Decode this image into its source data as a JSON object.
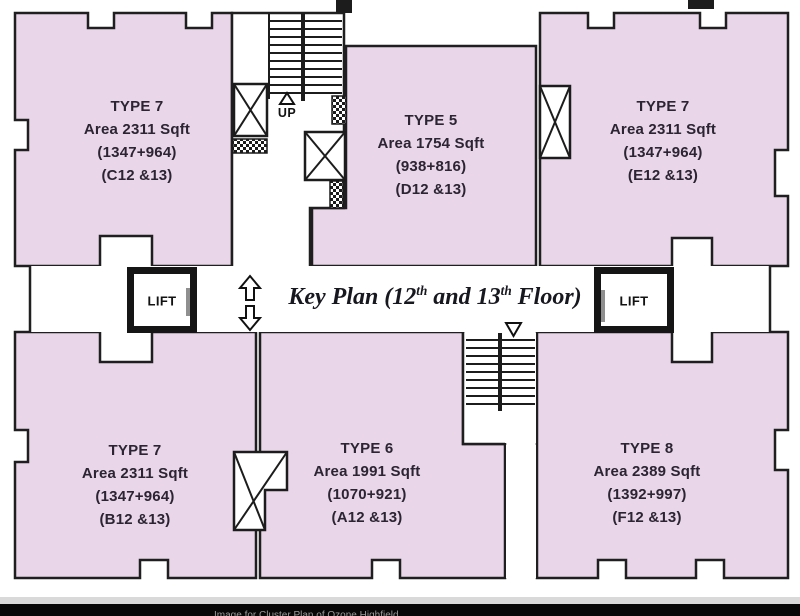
{
  "plan": {
    "title": {
      "pre": "Key Plan (12",
      "sup1": "th",
      "mid": " and 13",
      "sup2": "th",
      "post": " Floor)"
    },
    "units": [
      {
        "id": "C",
        "position": "top-left",
        "type": "TYPE 7",
        "area": "Area 2311 Sqft",
        "breakup": "(1347+964)",
        "flats": "(C12 &13)"
      },
      {
        "id": "D",
        "position": "top-middle",
        "type": "TYPE 5",
        "area": "Area 1754 Sqft",
        "breakup": "(938+816)",
        "flats": "(D12 &13)"
      },
      {
        "id": "E",
        "position": "top-right",
        "type": "TYPE 7",
        "area": "Area 2311 Sqft",
        "breakup": "(1347+964)",
        "flats": "(E12 &13)"
      },
      {
        "id": "B",
        "position": "bottom-left",
        "type": "TYPE 7",
        "area": "Area 2311 Sqft",
        "breakup": "(1347+964)",
        "flats": "(B12 &13)"
      },
      {
        "id": "A",
        "position": "bottom-middle",
        "type": "TYPE 6",
        "area": "Area 1991 Sqft",
        "breakup": "(1070+921)",
        "flats": "(A12 &13)"
      },
      {
        "id": "F",
        "position": "bottom-right",
        "type": "TYPE 8",
        "area": "Area 2389 Sqft",
        "breakup": "(1392+997)",
        "flats": "(F12 &13)"
      }
    ],
    "lifts": {
      "left": "LIFT",
      "right": "LIFT"
    },
    "stairs": {
      "up_label": "UP"
    },
    "caption": "Image for Cluster Plan of Ozone Highfield",
    "colors": {
      "unit_fill": "#e9d6e9",
      "wall": "#1f1f1f",
      "caption_bg": "#070707"
    }
  }
}
